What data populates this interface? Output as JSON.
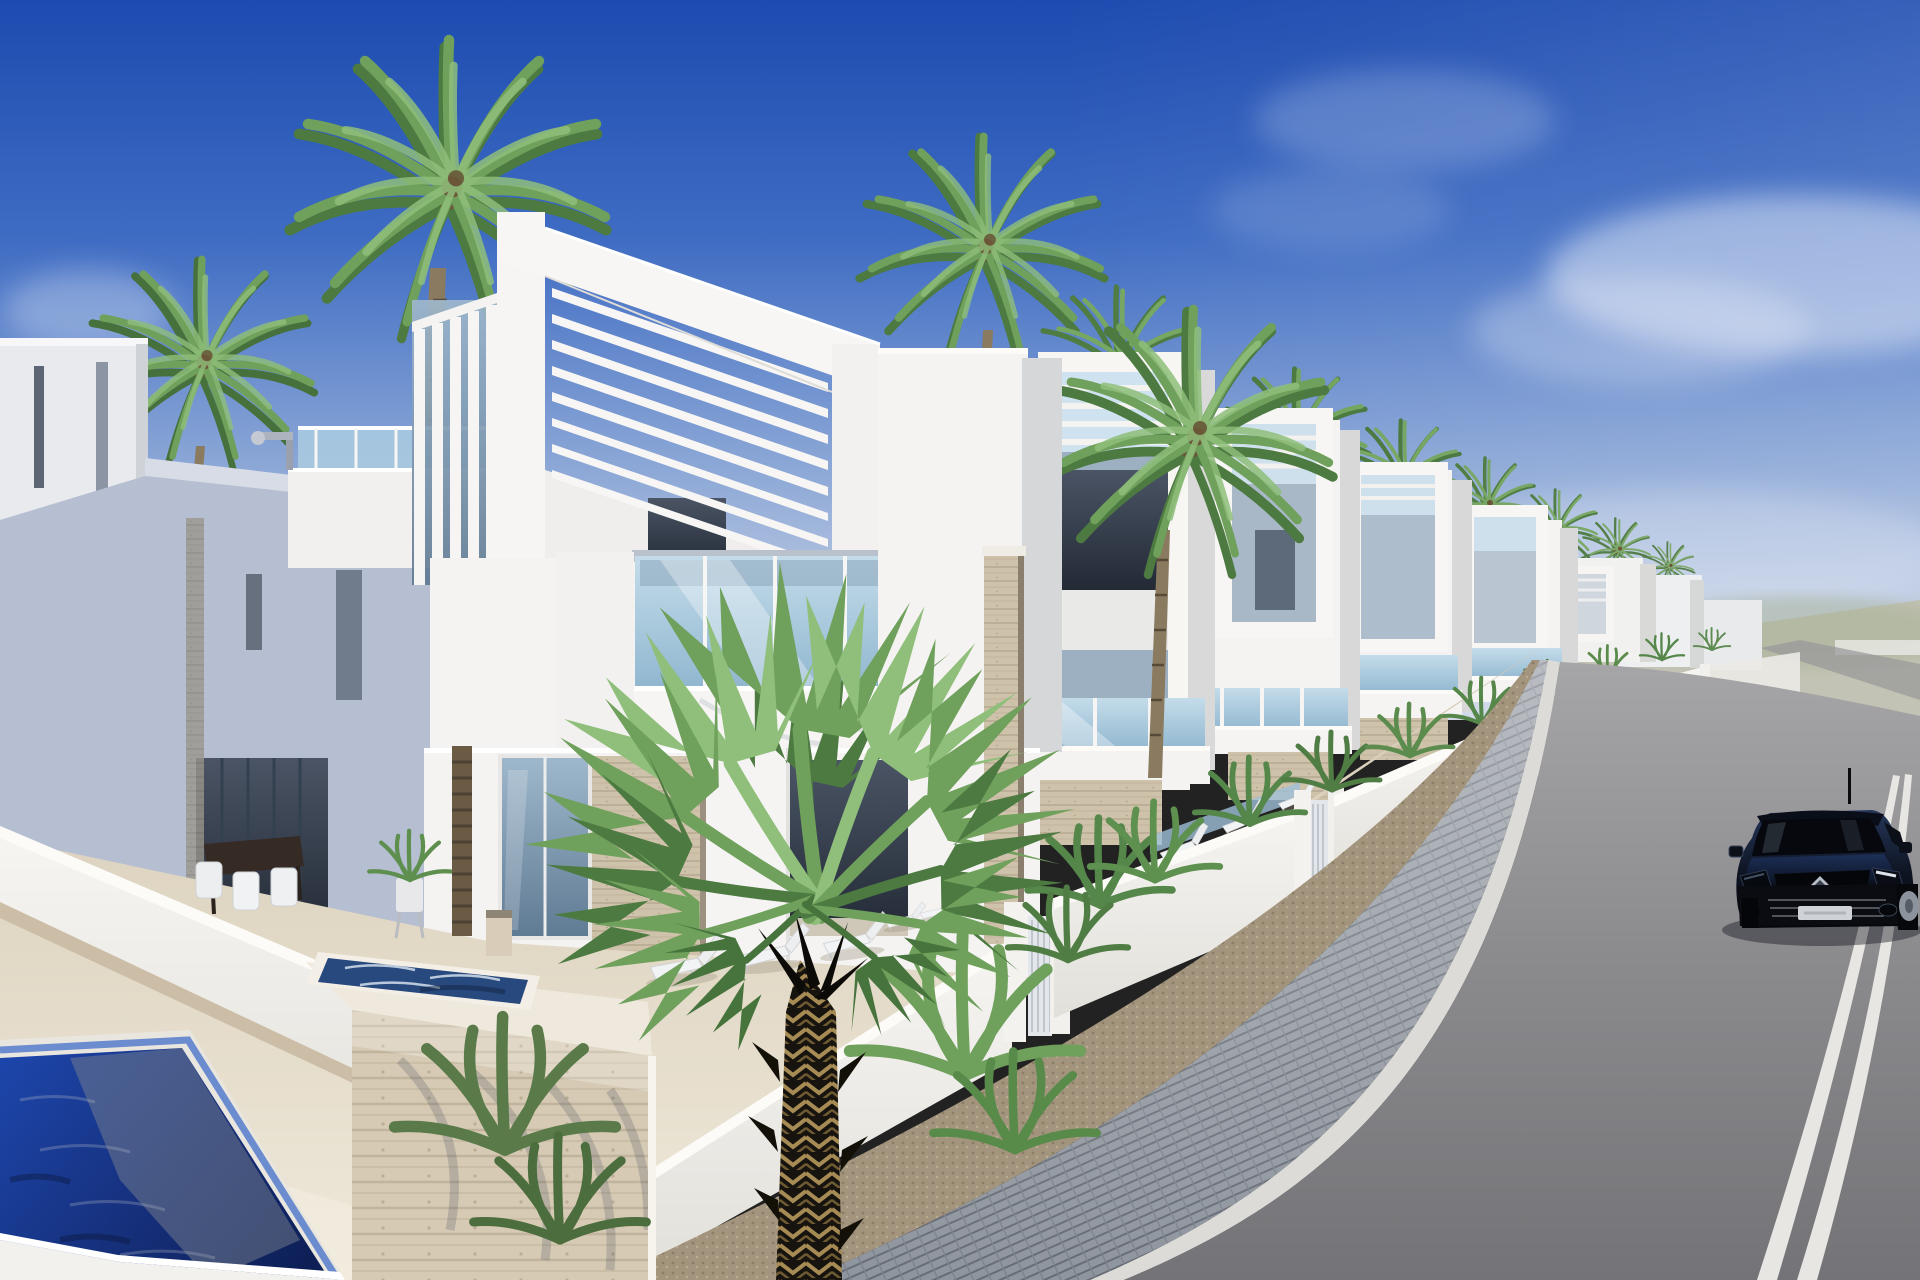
{
  "scene": {
    "description": "3D architectural render of a street of new-build modern white villas with rooftop pergolas, palm trees, private pools, a paved sidewalk and a black Renault hatchback driving on the asphalt road under a deep blue sky",
    "sky": {
      "top": "#1c4bb0",
      "mid": "#3f6cc3",
      "low": "#8aa6d6",
      "horizon": "#c6d1e4",
      "cloud": "#edf2f9"
    },
    "architecture": {
      "white_sunlit": "#f4f3f1",
      "white_bright": "#fcfbf8",
      "side_face": "#d7d8d7",
      "shadow_face": "#b6bfd1",
      "shadow_dark": "#6d7890",
      "glass_light": "#c4dcea",
      "glass_deep": "#8fb6cf",
      "interior_dark": "#4a5464",
      "interior_deep": "#232a36",
      "marble": "#cfc2ab",
      "marble_dark": "#a2947c",
      "stone_base": "#cbbda6"
    },
    "ground": {
      "sand_far": "#d5cab5",
      "sand_near": "#efe8d9",
      "terrace": "#e6ddcd",
      "gravel": "#a3947d",
      "gravel_dark": "#8b7d66",
      "paver": "#8f959e",
      "paver_joint": "#666c76",
      "curb": "#dcdbd7"
    },
    "road": {
      "asphalt_far": "#a8a7a9",
      "asphalt_mid": "#8b8a8d",
      "asphalt_near": "#747377",
      "marking": "#e7e6e3"
    },
    "pool": {
      "tile": "#5d82cc",
      "deep": "#0d1f55",
      "mid": "#1d47ae",
      "reflection": "#78808e",
      "spa": "#27497e",
      "sparkle": "#dfe9f2"
    },
    "vegetation": {
      "frond_mid": "#6fa05c",
      "frond_dark": "#4c7a41",
      "frond_light": "#8fbf7b",
      "shrub_green": "#55864a",
      "trunk": "#8a7a5f",
      "trunk_dark": "#564a39",
      "fg_trunk": "#17130e",
      "fg_trunk_tan": "#a68b55"
    },
    "car": {
      "body_top": "#26365a",
      "body_dark": "#05070c",
      "bonnet": "#1d2f57",
      "glass": "#06080e",
      "trim": "#7d848e",
      "logo_silver": "#b9bfc8",
      "plate": "#cfd3d8",
      "tire": "#07080c",
      "rim": "#8d939c"
    },
    "lamp": {
      "metal": "#aeb4bf"
    },
    "objects": [
      "blue sky",
      "soft clouds",
      "row of white modern villas",
      "rooftop pergola slats",
      "vertical louver fins",
      "glass balconies",
      "palm trees",
      "street garden walls",
      "slatted entrance gates",
      "street plants",
      "swimming pool",
      "raised spa pool",
      "marble planter block",
      "outdoor dining set",
      "potted plant",
      "sun loungers",
      "street lamp",
      "sand terrace",
      "gravel strip",
      "paved sidewalk",
      "white curb",
      "asphalt road",
      "double white road lines",
      "black renault hatchback"
    ]
  }
}
